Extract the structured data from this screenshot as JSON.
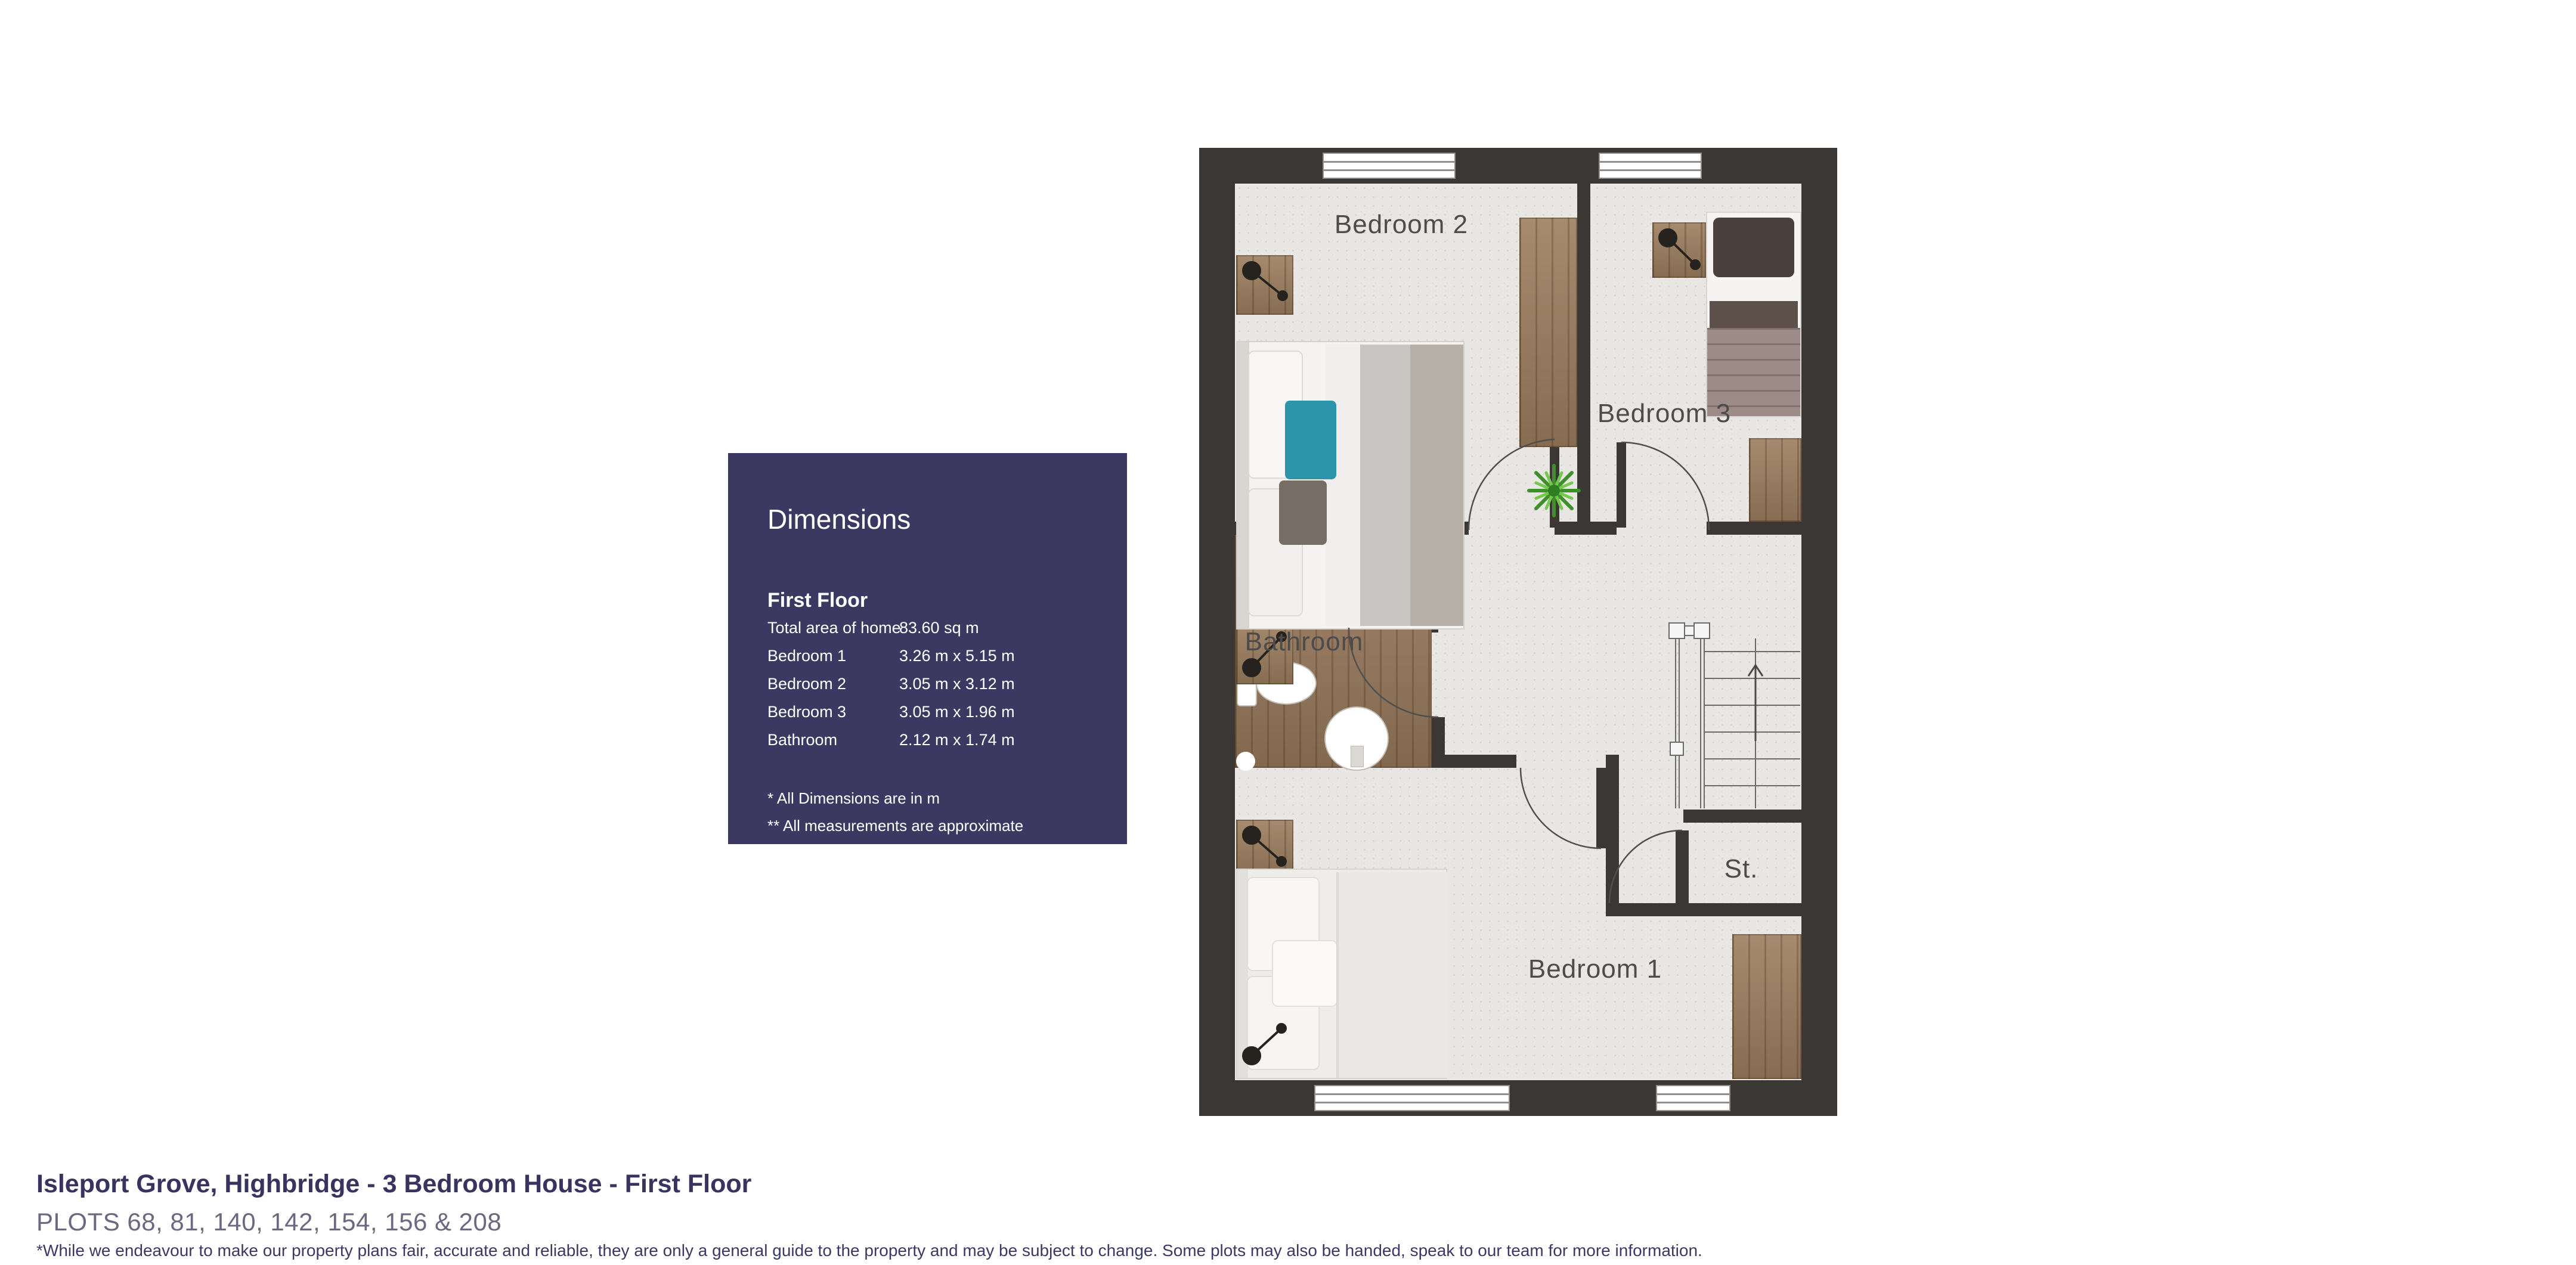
{
  "plan": {
    "labels": {
      "bedroom2": "Bedroom 2",
      "bedroom3": "Bedroom 3",
      "bathroom": "Bathroom",
      "bedroom1": "Bedroom 1",
      "storage": "St."
    }
  },
  "dimensions_panel": {
    "title": "Dimensions",
    "floor_label": "First Floor",
    "rows": [
      {
        "label": "Total area of home",
        "value": "83.60 sq m"
      },
      {
        "label": "Bedroom 1",
        "value": "3.26 m x 5.15 m"
      },
      {
        "label": "Bedroom 2",
        "value": "3.05 m x 3.12 m"
      },
      {
        "label": "Bedroom 3",
        "value": "3.05 m x 1.96 m"
      },
      {
        "label": "Bathroom",
        "value": "2.12 m x 1.74 m"
      }
    ],
    "notes": [
      "* All Dimensions are in m",
      "** All measurements are approximate"
    ]
  },
  "footer": {
    "title": "Isleport Grove, Highbridge - 3 Bedroom House - First Floor",
    "plots": "PLOTS 68, 81, 140, 142, 154, 156 & 208",
    "disclaimer": "*While we endeavour to make our property plans fair, accurate and reliable, they are only a general guide to the property and may be subject to change. Some plots may also be handed, speak to our team for more information."
  },
  "colors": {
    "wall": "#3a3734",
    "floor": "#e9e7e4",
    "wood": "#9c7e5e",
    "panel_bg": "#3b3862",
    "accent_teal": "#2b95a9",
    "title_text": "#38335f"
  }
}
